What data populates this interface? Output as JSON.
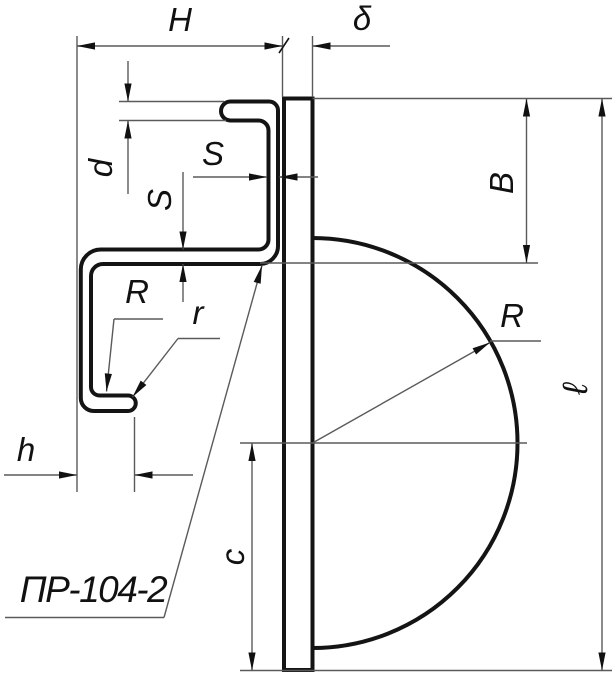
{
  "colors": {
    "background": "#ffffff",
    "outline": "#141414",
    "thin_line": "#5a5a5a",
    "text": "#111111"
  },
  "part_label": {
    "text": "ПР-104-2"
  },
  "dimension_labels": {
    "overall_width": "H",
    "plate_thickness": "δ",
    "flange_gap": "d",
    "sheet_thickness_web": "S",
    "sheet_thickness_flange": "S",
    "bend_radius_large": "R",
    "bend_radius_small": "r",
    "hook_width": "h",
    "top_offset": "B",
    "disc_radius": "R",
    "plate_length": "ℓ",
    "center_offset": "c"
  }
}
